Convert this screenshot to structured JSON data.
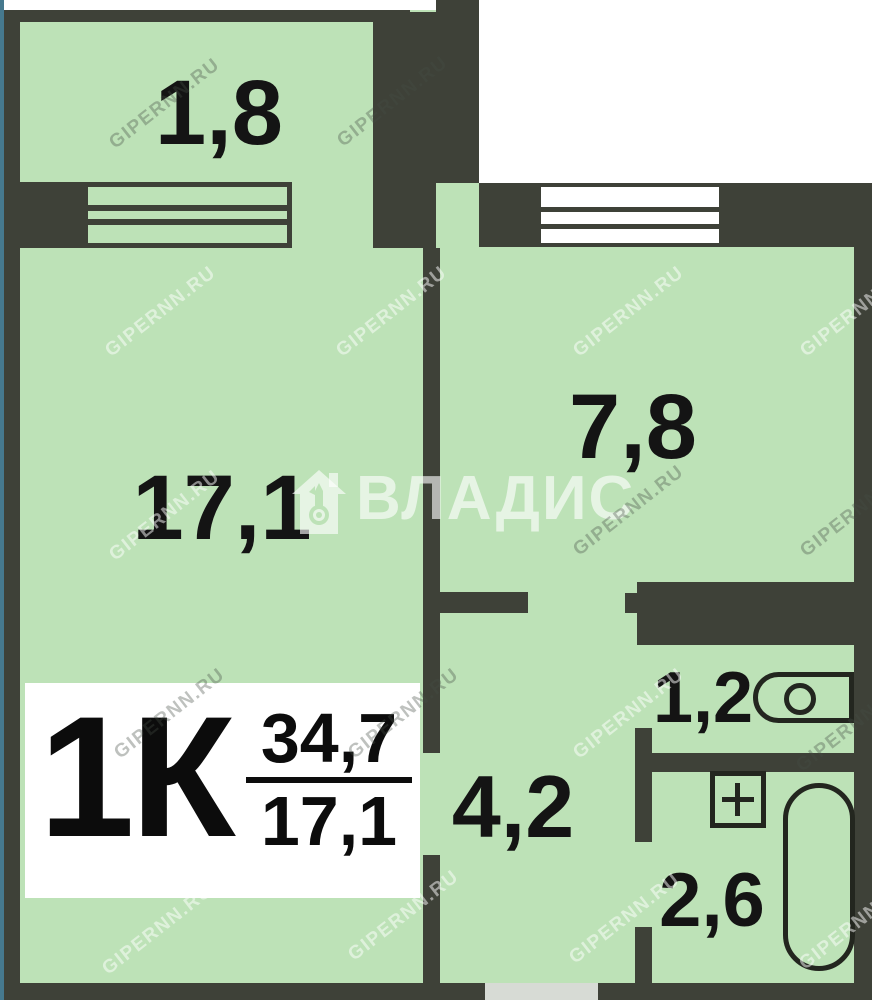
{
  "plan_title": {
    "type_label": "1К",
    "area_total": "34,7",
    "area_living": "17,1"
  },
  "rooms": [
    {
      "name": "balcony",
      "area_label": "1,8"
    },
    {
      "name": "living-room",
      "area_label": "17,1"
    },
    {
      "name": "kitchen",
      "area_label": "7,8"
    },
    {
      "name": "toilet",
      "area_label": "1,2"
    },
    {
      "name": "hallway",
      "area_label": "4,2"
    },
    {
      "name": "bathroom",
      "area_label": "2,6"
    }
  ],
  "colors": {
    "room_fill": "#bde2b7",
    "wall": "#3e4138",
    "fixture_outline": "#23261f",
    "outside": "#ffffff",
    "left_edge_strip": "#46798e",
    "entrance_gap": "#d7dbd5",
    "label_text": "#141414"
  },
  "brand_watermark": {
    "text": "ВЛАДИС",
    "icon": "house-key-icon"
  },
  "site_watermark": {
    "text": "GIPERNN.RU",
    "instances": [
      {
        "x": 165,
        "y": 104,
        "tone": "dark"
      },
      {
        "x": 393,
        "y": 102,
        "tone": "dark"
      },
      {
        "x": 161,
        "y": 312,
        "tone": "light"
      },
      {
        "x": 392,
        "y": 312,
        "tone": "light"
      },
      {
        "x": 629,
        "y": 312,
        "tone": "light"
      },
      {
        "x": 856,
        "y": 312,
        "tone": "light"
      },
      {
        "x": 165,
        "y": 516,
        "tone": "light"
      },
      {
        "x": 629,
        "y": 511,
        "tone": "dark"
      },
      {
        "x": 856,
        "y": 512,
        "tone": "dark"
      },
      {
        "x": 170,
        "y": 714,
        "tone": "dark"
      },
      {
        "x": 404,
        "y": 714,
        "tone": "dark"
      },
      {
        "x": 629,
        "y": 714,
        "tone": "light"
      },
      {
        "x": 852,
        "y": 727,
        "tone": "dark"
      },
      {
        "x": 158,
        "y": 930,
        "tone": "light"
      },
      {
        "x": 404,
        "y": 916,
        "tone": "light"
      },
      {
        "x": 625,
        "y": 919,
        "tone": "light"
      },
      {
        "x": 855,
        "y": 925,
        "tone": "light"
      }
    ]
  }
}
